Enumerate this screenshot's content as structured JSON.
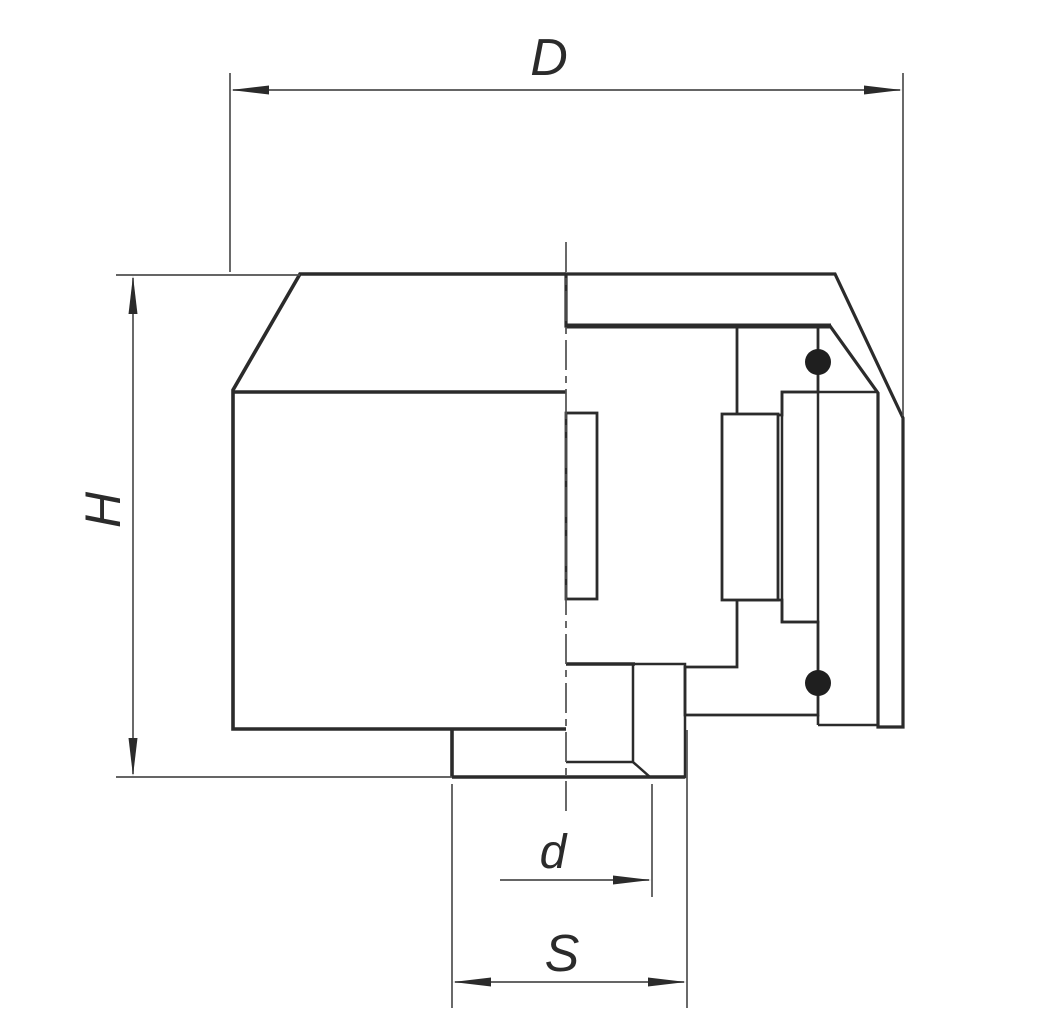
{
  "drawing": {
    "title": "cap-fitting-cross-section",
    "dimension_labels": {
      "outer_diameter": "D",
      "height": "H",
      "bore_diameter": "d",
      "socket_diameter": "S"
    },
    "colors": {
      "background": "#ffffff",
      "outline": "#2b2b2b",
      "dimension_line": "#4f4f4f",
      "oring_fill": "#1f1f1f"
    }
  }
}
